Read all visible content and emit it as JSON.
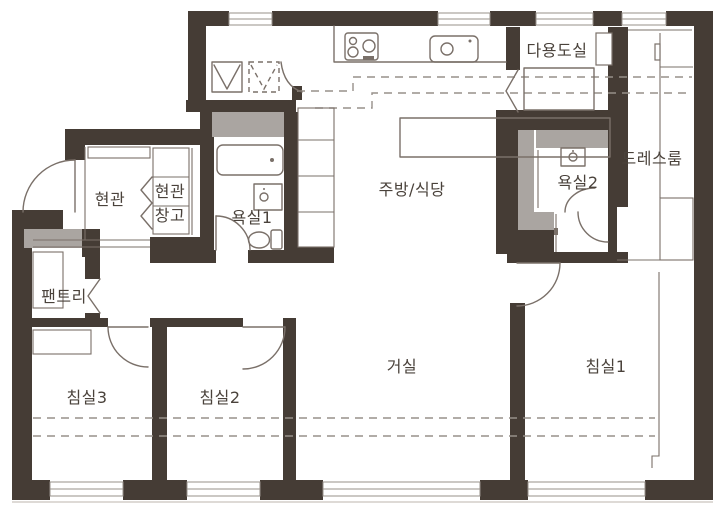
{
  "rooms": {
    "entrance": "현관",
    "entrance_storage_line1": "현관",
    "entrance_storage_line2": "창고",
    "pantry": "팬트리",
    "bathroom1": "욕실1",
    "bathroom2": "욕실2",
    "kitchen_dining": "주방/식당",
    "utility_room": "다용도실",
    "dress_room": "드레스룸",
    "living_room": "거실",
    "bedroom1": "침실1",
    "bedroom2": "침실2",
    "bedroom3": "침실3"
  },
  "colors": {
    "wall": "#453c35",
    "duct": "#aaa5a1",
    "line": "#7a7069",
    "dash": "#97908a",
    "label": "#4a423b",
    "background": "#ffffff"
  },
  "fixture_symbols": [
    "refrigerator-space",
    "kimchi-refrigerator-space-dashed",
    "cooktop",
    "kitchen-sink",
    "island-counter",
    "tall-cabinet-column",
    "bathtub",
    "washbasin",
    "toilet",
    "shower-stall",
    "washer-box",
    "folding-door",
    "shoe-cabinet",
    "storage-shelf",
    "pantry-shelf",
    "bedroom-closet",
    "dressroom-closet",
    "door-swing-arc",
    "window",
    "duct-shaft",
    "balcony-extension-dashed-line"
  ]
}
